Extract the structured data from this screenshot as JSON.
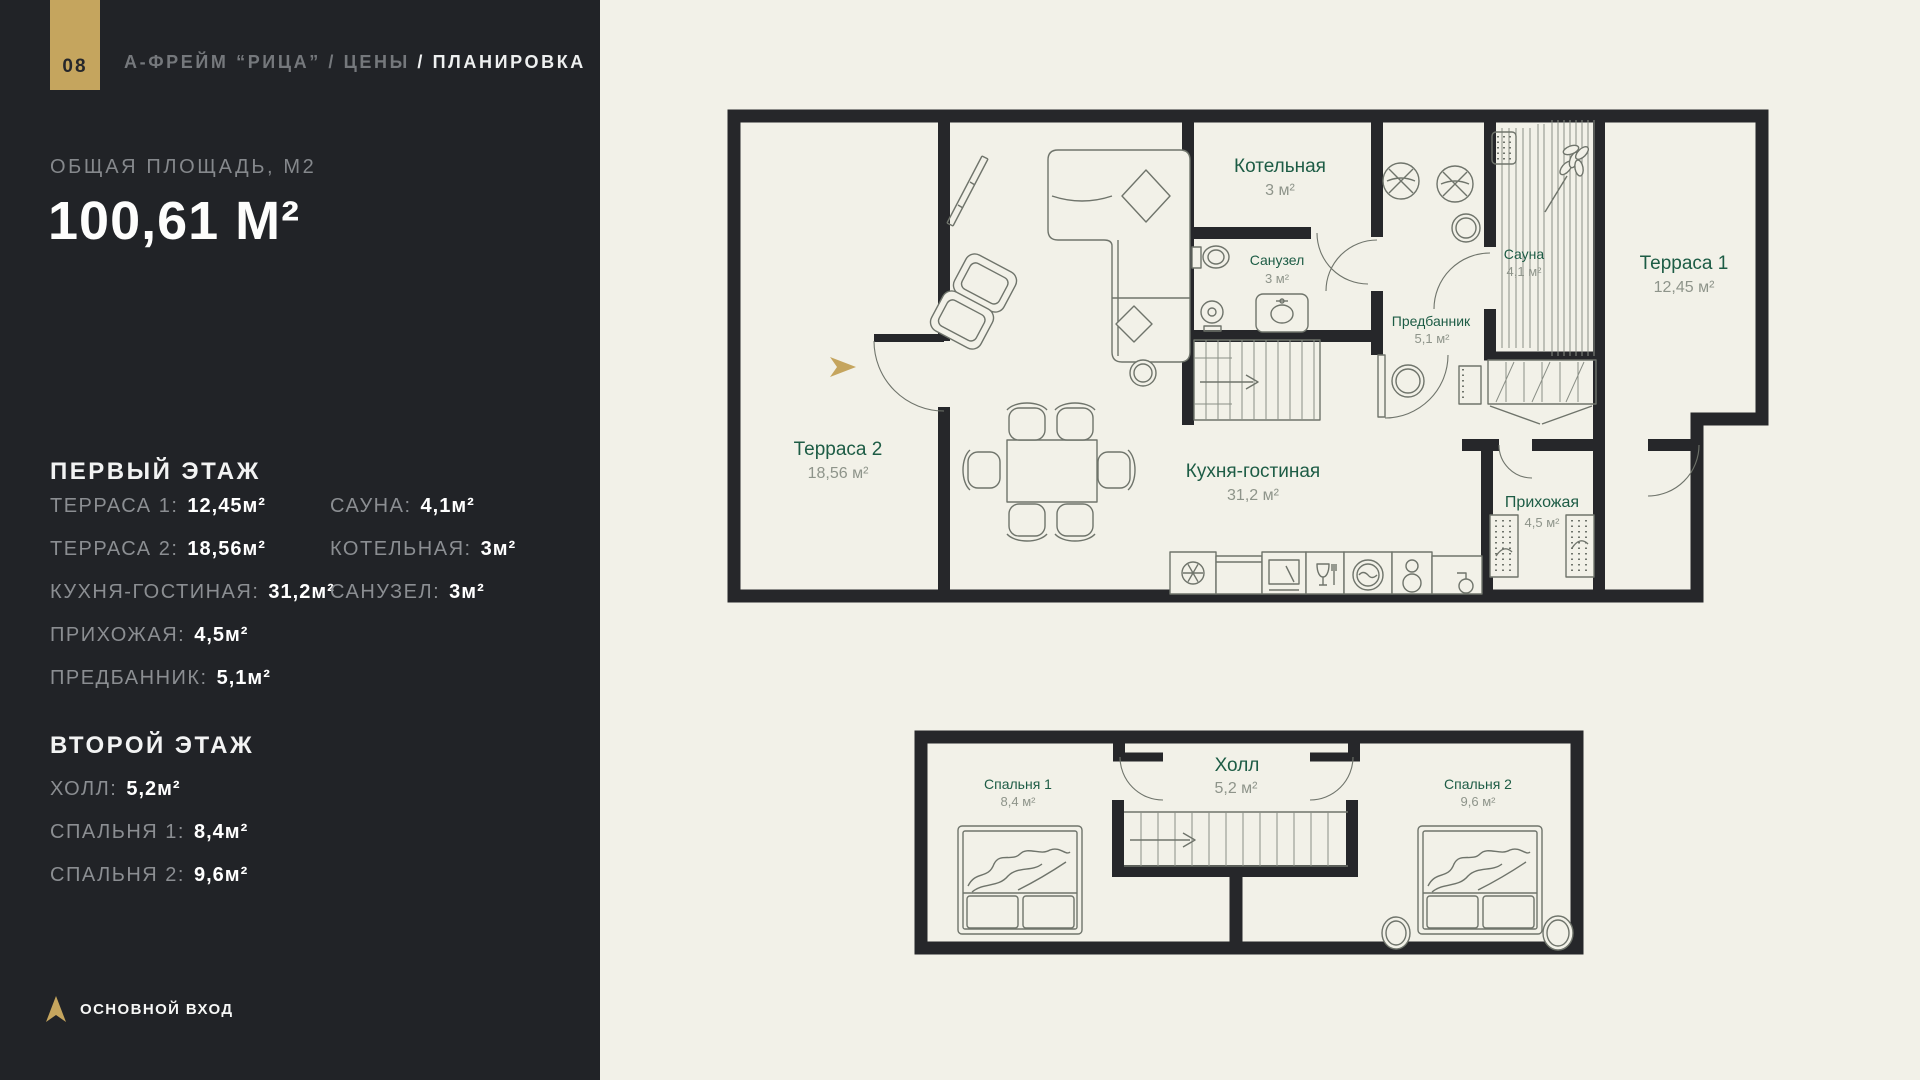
{
  "page": {
    "number": "08"
  },
  "breadcrumb": {
    "part1": "А-ФРЕЙМ “РИЦА”",
    "sep1": "/",
    "part2": "ЦЕНЫ",
    "sep2": "/",
    "current": "ПЛАНИРОВКА"
  },
  "total_area": {
    "label": "ОБЩАЯ ПЛОЩАДЬ, М2",
    "value": "100,61 М²"
  },
  "sidebar": {
    "first_floor": {
      "title": "ПЕРВЫЙ ЭТАЖ",
      "left": [
        {
          "label": "ТЕРРАСА 1:",
          "value": "12,45м²"
        },
        {
          "label": "ТЕРРАСА 2:",
          "value": "18,56м²"
        },
        {
          "label": "КУХНЯ-ГОСТИНАЯ:",
          "value": "31,2м²"
        },
        {
          "label": "ПРИХОЖАЯ:",
          "value": "4,5м²"
        },
        {
          "label": "ПРЕДБАННИК:",
          "value": "5,1м²"
        }
      ],
      "right": [
        {
          "label": "САУНА:",
          "value": "4,1м²"
        },
        {
          "label": "КОТЕЛЬНАЯ:",
          "value": "3м²"
        },
        {
          "label": "САНУЗЕЛ:",
          "value": "3м²"
        }
      ]
    },
    "second_floor": {
      "title": "ВТОРОЙ ЭТАЖ",
      "items": [
        {
          "label": "ХОЛЛ:",
          "value": "5,2м²"
        },
        {
          "label": "СПАЛЬНЯ 1:",
          "value": "8,4м²"
        },
        {
          "label": "СПАЛЬНЯ 2:",
          "value": "9,6м²"
        }
      ]
    },
    "legend": {
      "label": "ОСНОВНОЙ ВХОД"
    }
  },
  "plan1": {
    "name": "Первый этаж",
    "rooms": [
      {
        "name": "Котельная",
        "area": "3 м²"
      },
      {
        "name": "Санузел",
        "area": "3 м²"
      },
      {
        "name": "Сауна",
        "area": "4,1 м²"
      },
      {
        "name": "Терраса 1",
        "area": "12,45 м²"
      },
      {
        "name": "Предбанник",
        "area": "5,1 м²"
      },
      {
        "name": "Терраса 2",
        "area": "18,56 м²"
      },
      {
        "name": "Кухня-гостиная",
        "area": "31,2 м²"
      },
      {
        "name": "Прихожая",
        "area": "4,5 м²"
      }
    ]
  },
  "plan2": {
    "name": "Второй этаж",
    "rooms": [
      {
        "name": "Спальня 1",
        "area": "8,4 м²"
      },
      {
        "name": "Холл",
        "area": "5,2 м²"
      },
      {
        "name": "Спальня 2",
        "area": "9,6 м²"
      }
    ]
  },
  "colors": {
    "background": "#f2f1e8",
    "sidebar_bg": "#212327",
    "accent_gold": "#c5a55e",
    "wall": "#26272a",
    "room_label_green": "#1d5c45",
    "area_value_gray": "#8e948a",
    "sidebar_label_gray": "#8b8e92",
    "text_white": "#ffffff"
  }
}
